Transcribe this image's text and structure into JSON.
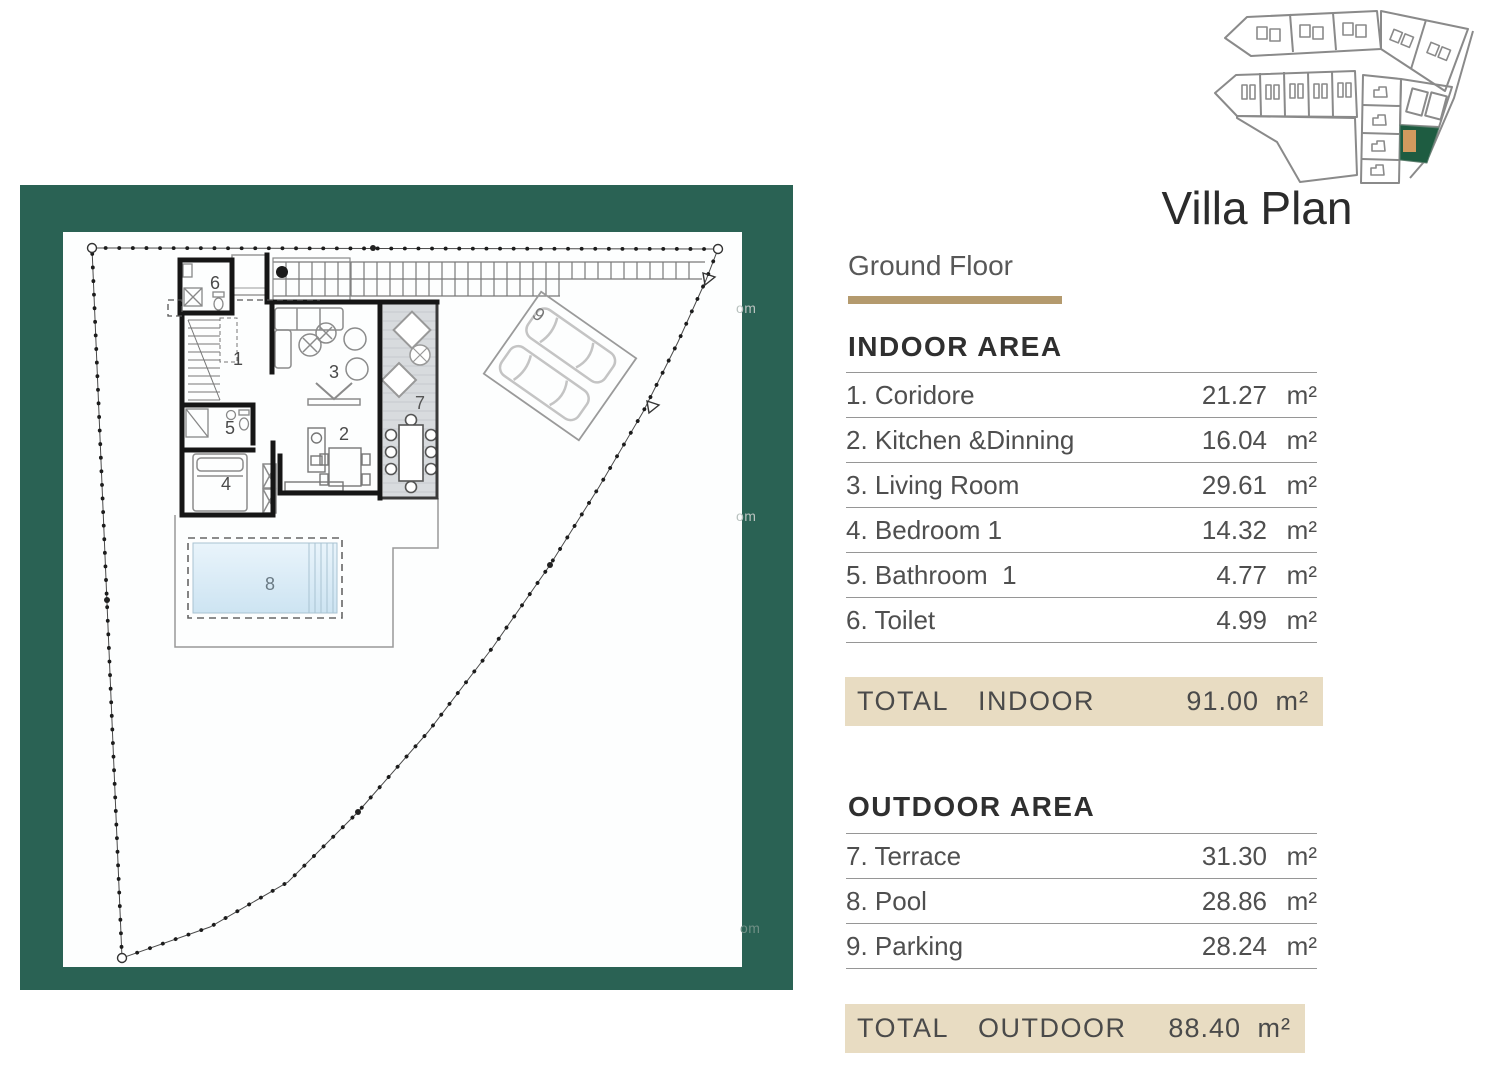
{
  "title": "Villa Plan",
  "subtitle": "Ground Floor",
  "colors": {
    "frame_green": "#2a6254",
    "accent_tan": "#b49a6e",
    "total_bar_bg": "#e8dcc2",
    "pool_blue": "#d9ebf6",
    "terrace_gray": "#d8dbde",
    "siteplan_highlight_green": "#1e5c41",
    "siteplan_house_tan": "#d29a5e"
  },
  "indoor": {
    "header": "INDOOR AREA",
    "rows": [
      {
        "label": "1. Coridore",
        "value": "21.27",
        "unit": "m²"
      },
      {
        "label": "2. Kitchen &Dinning",
        "value": "16.04",
        "unit": "m²"
      },
      {
        "label": "3. Living Room",
        "value": "29.61",
        "unit": "m²"
      },
      {
        "label": "4. Bedroom 1",
        "value": "14.32",
        "unit": "m²"
      },
      {
        "label": "5. Bathroom  1",
        "value": "4.77",
        "unit": "m²"
      },
      {
        "label": "6. Toilet",
        "value": "4.99",
        "unit": "m²"
      }
    ],
    "total": {
      "label": "TOTAL  INDOOR",
      "value": "91.00",
      "unit": "m²"
    }
  },
  "outdoor": {
    "header": "OUTDOOR AREA",
    "rows": [
      {
        "label": "7. Terrace",
        "value": "31.30",
        "unit": "m²"
      },
      {
        "label": "8. Pool",
        "value": "28.86",
        "unit": "m²"
      },
      {
        "label": "9. Parking",
        "value": "28.24",
        "unit": "m²"
      }
    ],
    "total": {
      "label": "TOTAL  OUTDOOR",
      "value": "88.40",
      "unit": "m²"
    }
  },
  "plan": {
    "room_numbers": [
      "1",
      "2",
      "3",
      "4",
      "5",
      "6",
      "7",
      "8",
      "9"
    ]
  },
  "watermarks": [
    "om",
    "om",
    "om"
  ]
}
